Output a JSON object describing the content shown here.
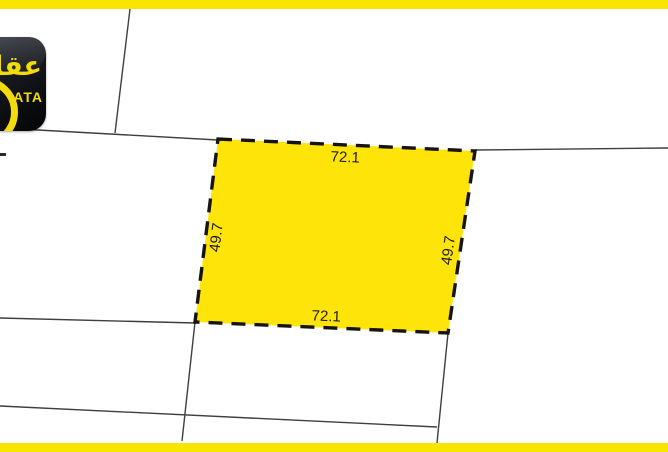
{
  "map": {
    "parcel": {
      "top_length": "72.1",
      "bottom_length": "72.1",
      "left_length": "49.7",
      "right_length": "49.7"
    }
  },
  "logo": {
    "arabic": "عقارتا",
    "latin_visible": "ATA"
  },
  "colors": {
    "bar_yellow": "#F8E600",
    "parcel_fill": "#FFE40A",
    "parcel_dashed_border": "#141414",
    "boundary_line": "#3F3F3F",
    "dimension_text": "#1C1C1C",
    "logo_background": "#0B0C0F",
    "logo_text": "#F2DC0C"
  }
}
